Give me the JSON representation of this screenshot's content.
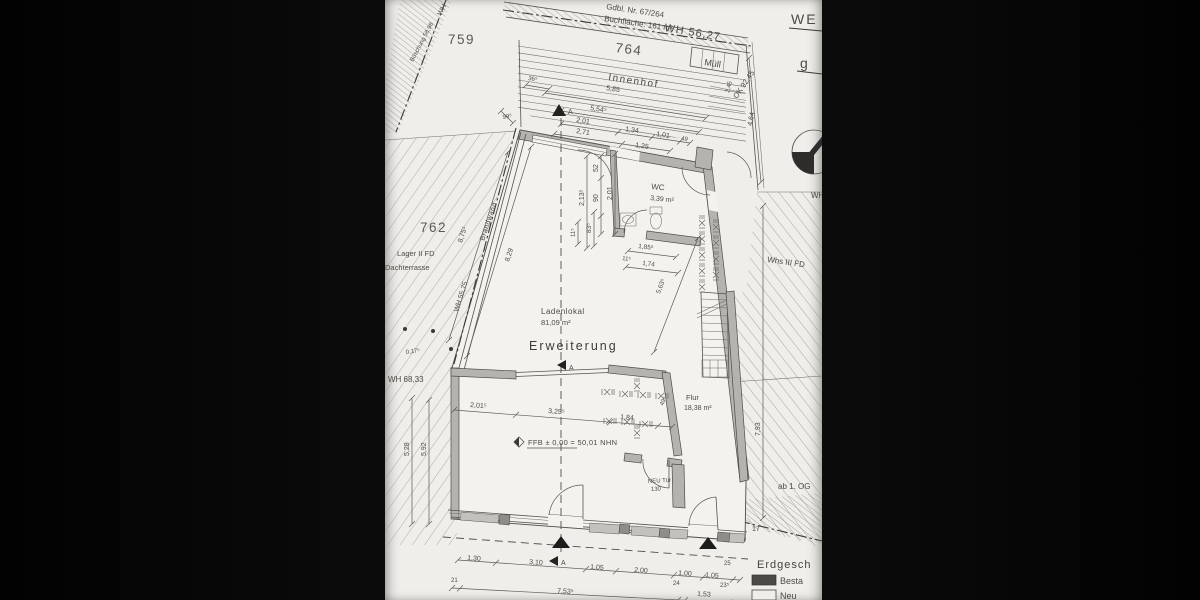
{
  "parcels": {
    "p759": "759",
    "p762": "762",
    "p764": "764"
  },
  "rooms": {
    "innenhof": "Innenhof",
    "muell": "Müll",
    "ladenlokal": "Ladenlokal",
    "ladenlokal_area": "81,09 m²",
    "erweiterung": "Erweiterung",
    "wc": "WC",
    "wc_area": "3,39 m²",
    "flur": "Flur",
    "flur_area": "18,38 m²"
  },
  "annotations": {
    "we": "WE",
    "g": "g",
    "gdbl": "Gdbl. Nr. 67/264",
    "buchflaeche": "Buchfläche: 161 m²",
    "wh_56_27": "WH 56,27",
    "ok_92_45": "OK 92,45",
    "wh_fragment": "WH",
    "boeschung": "Böschung 58,98",
    "brandwand": "Brandwand",
    "lager": "Lager II FD",
    "dachterrasse": "Dachterrasse",
    "wh_55_75": "WH 55,75",
    "wh_68_33": "WH 68,33",
    "whs_III_fd": "Whs III FD",
    "ab_1_og": "ab 1. OG",
    "ffb": "FFB ± 0,00 = 50,01 NHN",
    "neu_tuer": "NEU Tür",
    "neu_tuer_breite": "130",
    "section_a": "A",
    "erdgeschoss": "Erdgesch",
    "legend_bestand": "Besta",
    "legend_neu": "Neu"
  },
  "dimensions": {
    "top": {
      "d36": "36⁵",
      "d585": "5,85",
      "d554": "5,54⁵",
      "d99": "99⁵",
      "d201": "2,01",
      "d271": "2,71",
      "d134": "1,34",
      "d101": "1,01",
      "d49": "49",
      "d125": "1,25",
      "d245": "2,45",
      "d464": "4,64"
    },
    "wc": {
      "d52": "52",
      "d90": "90",
      "d201": "2,01",
      "d213": "2,13⁵",
      "d83": "83⁵",
      "d11a": "11⁵",
      "d185": "1,85⁵",
      "d11b": "11⁵",
      "d174": "1,74",
      "d563": "5,63⁵"
    },
    "west": {
      "d829": "8,29",
      "d875": "8,75⁵",
      "d528": "5,28",
      "d592": "5,92",
      "d017": "0,17⁵"
    },
    "mid": {
      "d2015": "2,01⁵",
      "d3255": "3,25⁵",
      "d184": "1,84",
      "d495": "49⁵"
    },
    "east": {
      "d793": "7,93",
      "d17": "17"
    },
    "bottom_row1": {
      "d130": "1,30",
      "d310": "3,10",
      "d105a": "1,05",
      "d200": "2,00",
      "d100": "1,00",
      "d105b": "1,05",
      "d25": "25"
    },
    "bottom_row2": {
      "d21": "21",
      "d753": "7,53⁵",
      "d24": "24",
      "d153": "1,53",
      "d23": "23⁵"
    }
  },
  "colors": {
    "paper": "#f0eeea",
    "bars": "#060606",
    "walls": "#b5b3af",
    "legend_bestand_chip": "#4c4a46"
  }
}
